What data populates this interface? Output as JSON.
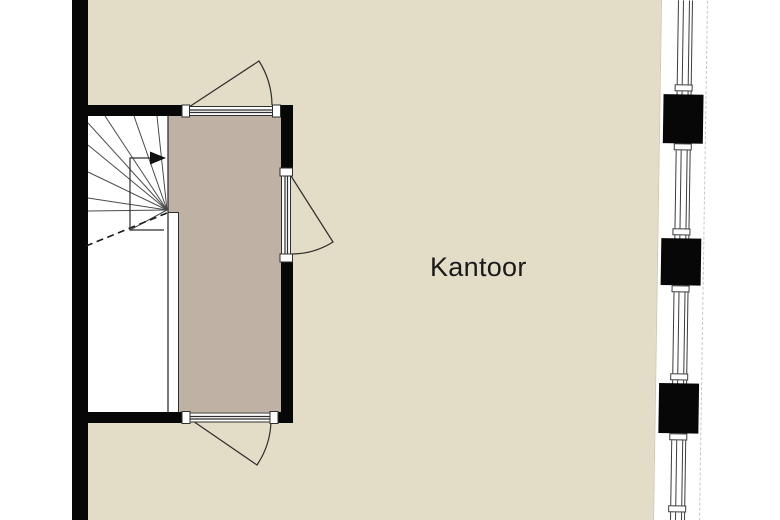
{
  "floorplan": {
    "room_label": "Kantoor",
    "colors": {
      "background": "#ffffff",
      "room_fill": "#e3dcc6",
      "hallway_fill": "#bfb2a4",
      "wall": "#070707",
      "line": "#2e2e2e",
      "tread": "#4a4a4a",
      "frame": "#3c3c3c"
    }
  }
}
